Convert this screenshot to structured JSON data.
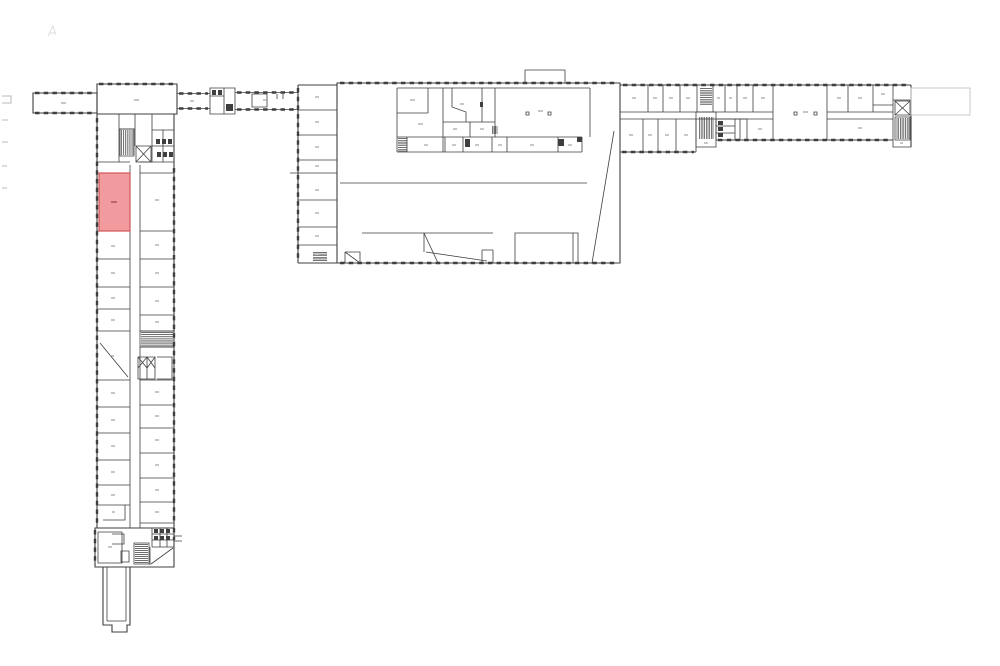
{
  "plan": {
    "background": "#ffffff",
    "wall_color": "#3f3f3f",
    "label_color": "#8f8f8f",
    "light_outline_color": "#c4c4c4",
    "faint_mark_color": "#dedede",
    "edge_tick_color": "#b8b8b8",
    "highlight_room": {
      "x": 99,
      "y": 173,
      "width": 31,
      "height": 58,
      "fill": "#f29b9e",
      "stroke": "#cf585c",
      "label_color": "#8c3a3e"
    }
  }
}
